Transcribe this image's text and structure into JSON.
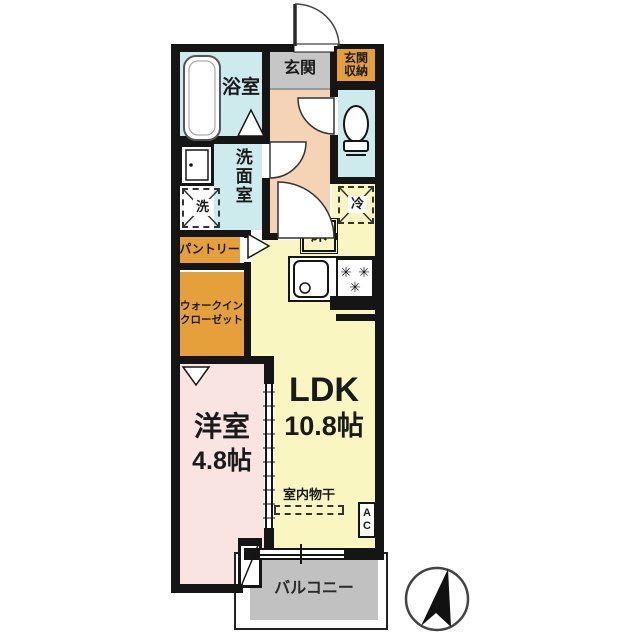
{
  "plan": {
    "bathroom_label": "浴室",
    "entrance_label": "玄関",
    "entrance_storage_line1": "玄関",
    "entrance_storage_line2": "収納",
    "washroom_label": "洗面室",
    "washer_label": "洗",
    "fridge_label": "冷",
    "floor_hatch_label": "床",
    "pantry_label": "パントリー",
    "wic_line1": "ウォークイン",
    "wic_line2": "クローゼット",
    "western_room_name": "洋室",
    "western_room_size": "4.8帖",
    "ldk_name": "LDK",
    "ldk_size": "10.8帖",
    "indoor_drying_label": "室内物干",
    "ac_line1": "A",
    "ac_line2": "C",
    "balcony_label": "バルコニー"
  },
  "colors": {
    "wall": "#151515",
    "wet_area": "#cdeaec",
    "entrance": "#c6c6c6",
    "storage_orange": "#e5a03c",
    "hallway": "#f4d4b4",
    "ldk_yellow": "#f9f6c2",
    "bedroom_pink": "#f9e4e2",
    "balcony_gray": "#c1c1c1"
  }
}
